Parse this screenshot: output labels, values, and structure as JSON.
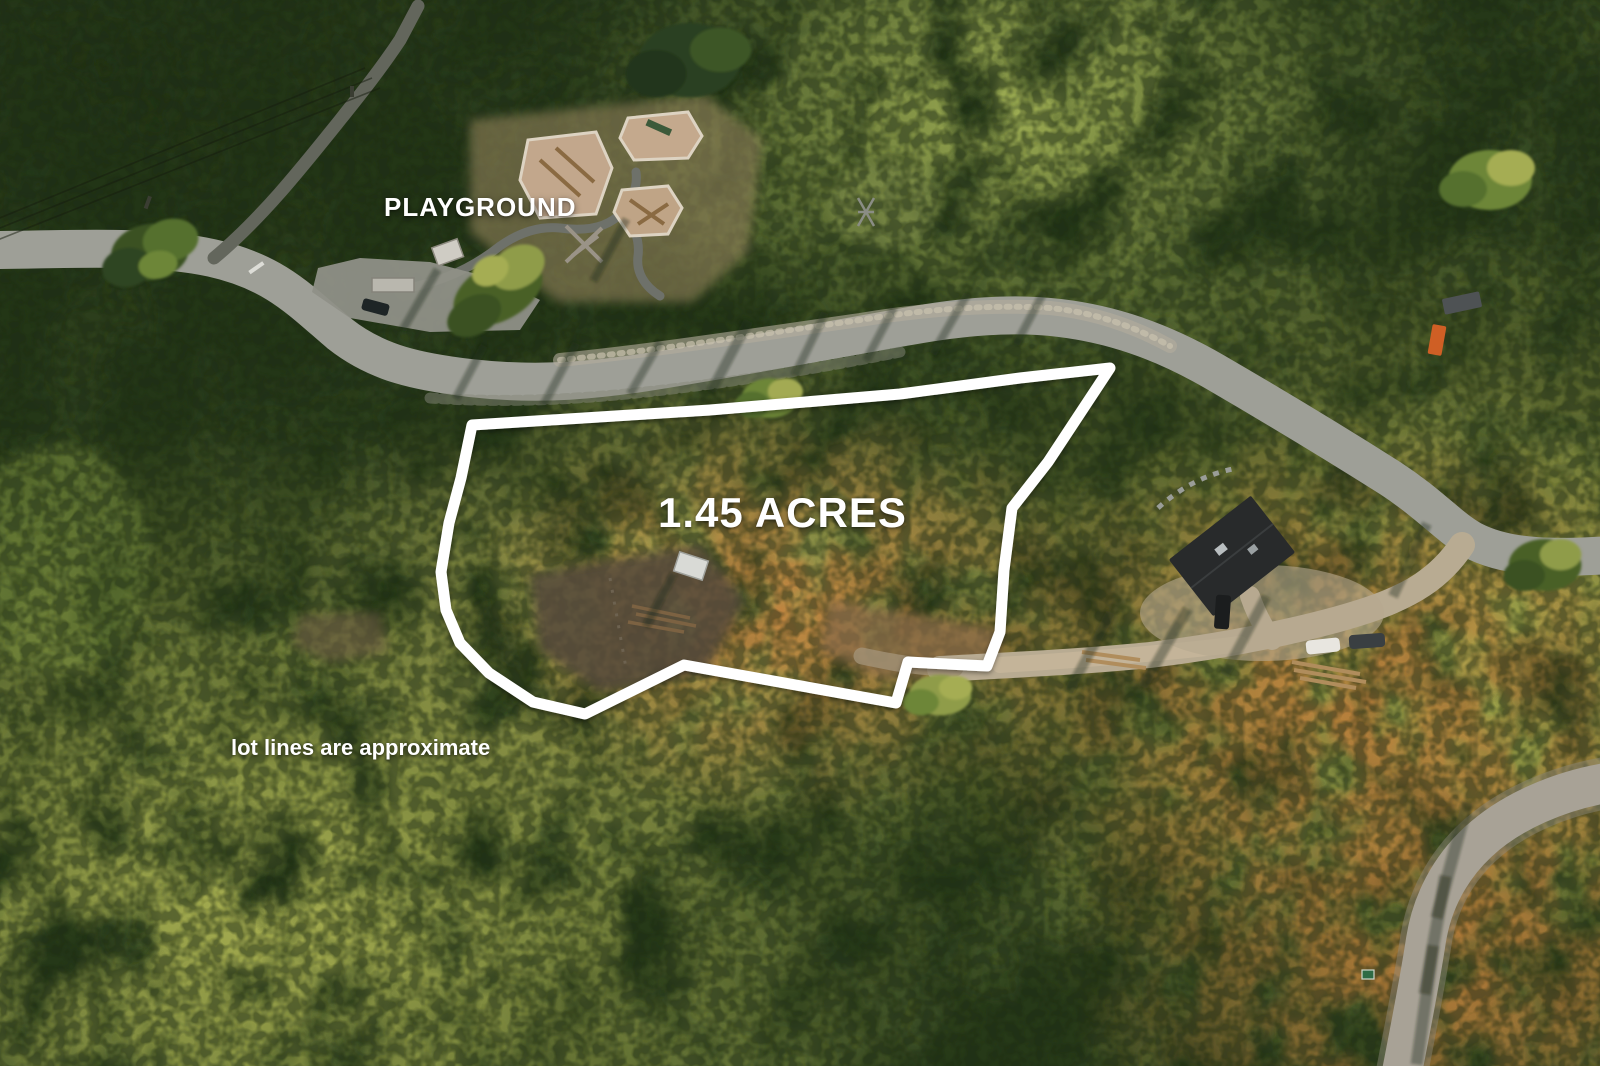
{
  "overlay": {
    "playground_label": "PLAYGROUND",
    "acreage_label": "1.45 ACRES",
    "disclaimer": "lot lines are approximate"
  },
  "colors": {
    "overlay_text": "#ffffff",
    "lot_boundary": "#ffffff",
    "forest_dark": "#2f4221",
    "forest_light": "#a9ad55",
    "sunlit_ground": "#c08440",
    "road_asphalt": "#9e9f97",
    "road_gravel": "#b8ab92",
    "house_roof": "#282a2b"
  }
}
